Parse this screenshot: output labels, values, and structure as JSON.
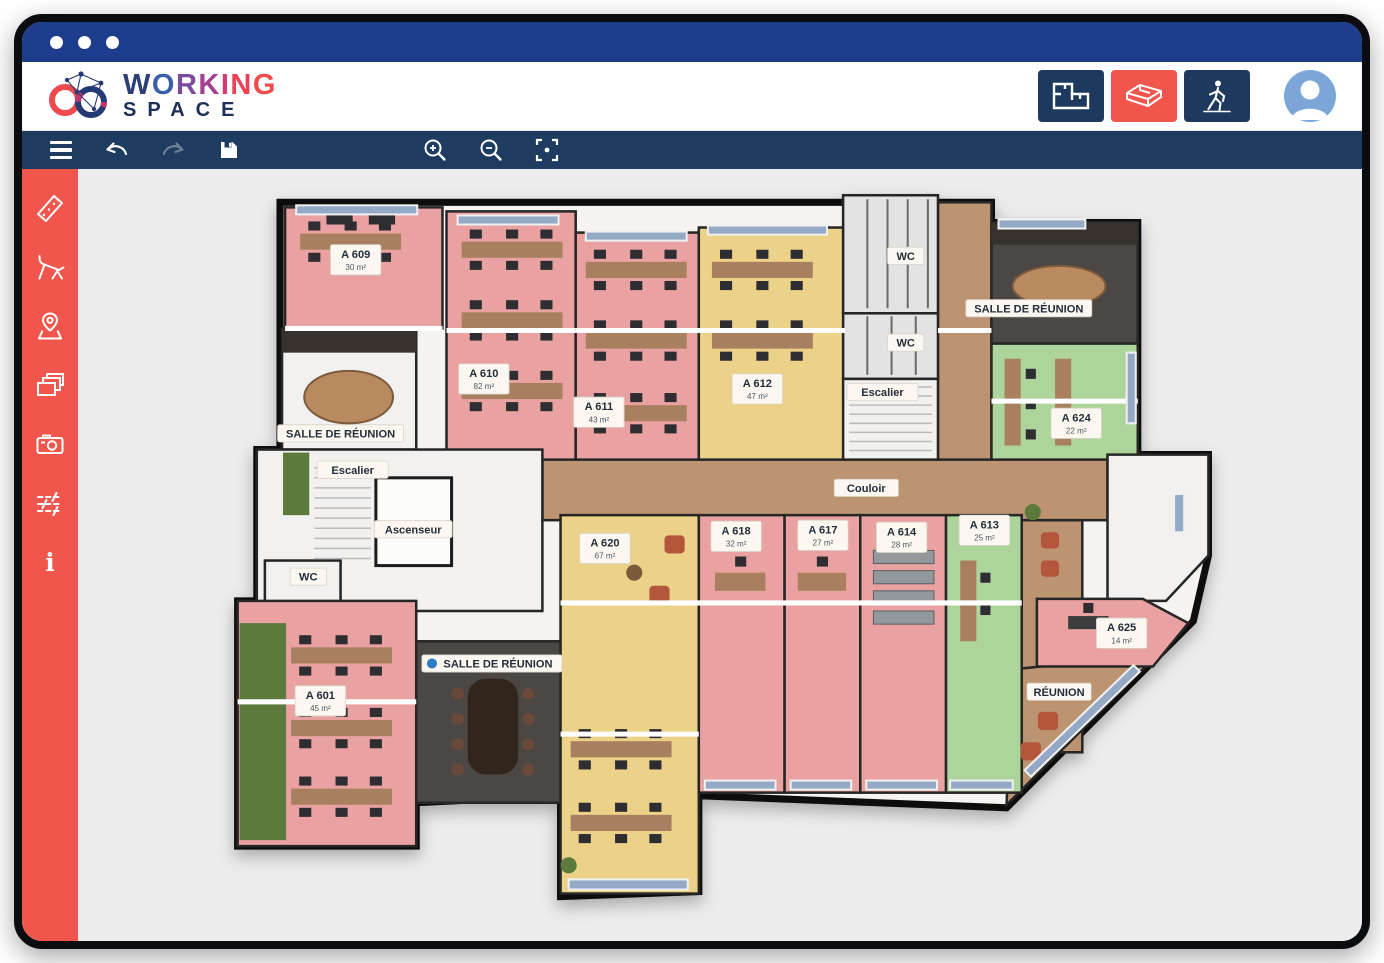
{
  "window": {
    "traffic_dots": 3,
    "titlebar_color": "#1e3c8c"
  },
  "brand": {
    "line1": "WORKING",
    "line2": "SPACE"
  },
  "header": {
    "view_modes": [
      {
        "id": "2d",
        "icon": "2d-floorplan-icon",
        "active": false
      },
      {
        "id": "3d",
        "icon": "3d-view-icon",
        "active": true
      },
      {
        "id": "walk",
        "icon": "walkthrough-person-icon",
        "active": false
      }
    ],
    "avatar_icon": "user-avatar"
  },
  "toolbar": {
    "items": [
      {
        "name": "menu",
        "icon": "hamburger-menu-icon"
      },
      {
        "name": "undo",
        "icon": "undo-arrow-icon"
      },
      {
        "name": "redo",
        "icon": "redo-arrow-icon",
        "disabled": true
      },
      {
        "name": "save",
        "icon": "save-floppy-icon"
      },
      {
        "name": "zoom-in",
        "icon": "zoom-in-icon"
      },
      {
        "name": "zoom-out",
        "icon": "zoom-out-icon"
      },
      {
        "name": "fit-view",
        "icon": "fit-to-screen-icon"
      }
    ]
  },
  "sidebar": {
    "color": "#f1564c",
    "items": [
      {
        "name": "measure",
        "icon": "ruler-icon"
      },
      {
        "name": "furniture",
        "icon": "chair-icon"
      },
      {
        "name": "location",
        "icon": "map-pin-icon"
      },
      {
        "name": "floors",
        "icon": "layers-icon"
      },
      {
        "name": "snapshot",
        "icon": "camera-icon"
      },
      {
        "name": "adjustments",
        "icon": "sliders-icon"
      },
      {
        "name": "info",
        "icon": "info-icon"
      }
    ]
  },
  "colors": {
    "accent_red": "#f1564c",
    "toolbar_navy": "#1d3c5f",
    "title_blue": "#1e3c8c",
    "canvas_bg": "#ececec",
    "room_pink": "#eaa1a1",
    "room_yellow": "#ecd189",
    "room_green": "#add49b",
    "corridor_wood": "#bc9471"
  },
  "floorplan": {
    "room_labels": [
      {
        "id": "a609",
        "name": "A 609",
        "area": "30 m²",
        "x": 269,
        "y": 90
      },
      {
        "id": "a610",
        "name": "A 610",
        "area": "82 m²",
        "x": 396,
        "y": 208
      },
      {
        "id": "salle-reunion-nw",
        "name": "SALLE DE RÉUNION",
        "x": 254,
        "y": 262
      },
      {
        "id": "a611",
        "name": "A 611",
        "area": "43 m²",
        "x": 510,
        "y": 241
      },
      {
        "id": "a612",
        "name": "A 612",
        "area": "47 m²",
        "x": 667,
        "y": 218
      },
      {
        "id": "wc-top",
        "name": "WC",
        "x": 814,
        "y": 86
      },
      {
        "id": "wc-mid",
        "name": "WC",
        "x": 814,
        "y": 172
      },
      {
        "id": "escalier-center",
        "name": "Escalier",
        "x": 791,
        "y": 221
      },
      {
        "id": "salle-reunion-ne",
        "name": "SALLE DE RÉUNION",
        "x": 936,
        "y": 138
      },
      {
        "id": "a624",
        "name": "A 624",
        "area": "22 m²",
        "x": 983,
        "y": 252
      },
      {
        "id": "couloir",
        "name": "Couloir",
        "x": 775,
        "y": 316
      },
      {
        "id": "escalier-west",
        "name": "Escalier",
        "x": 266,
        "y": 298
      },
      {
        "id": "ascenseur",
        "name": "Ascenseur",
        "x": 326,
        "y": 357
      },
      {
        "id": "wc-west",
        "name": "WC",
        "x": 222,
        "y": 404
      },
      {
        "id": "a601",
        "name": "A 601",
        "area": "45 m²",
        "x": 234,
        "y": 527
      },
      {
        "id": "salle-reunion-s",
        "name": "SALLE DE RÉUNION",
        "x": 404,
        "y": 490,
        "pin": true
      },
      {
        "id": "a620",
        "name": "A 620",
        "area": "67 m²",
        "x": 516,
        "y": 376
      },
      {
        "id": "a618",
        "name": "A 618",
        "area": "32 m²",
        "x": 646,
        "y": 364
      },
      {
        "id": "a617",
        "name": "A 617",
        "area": "27 m²",
        "x": 732,
        "y": 363
      },
      {
        "id": "a614",
        "name": "A 614",
        "area": "28 m²",
        "x": 810,
        "y": 365
      },
      {
        "id": "a613",
        "name": "A 613",
        "area": "25 m²",
        "x": 892,
        "y": 358
      },
      {
        "id": "a625",
        "name": "A 625",
        "area": "14 m²",
        "x": 1028,
        "y": 460
      },
      {
        "id": "reunion",
        "name": "RÉUNION",
        "x": 966,
        "y": 518
      }
    ]
  }
}
